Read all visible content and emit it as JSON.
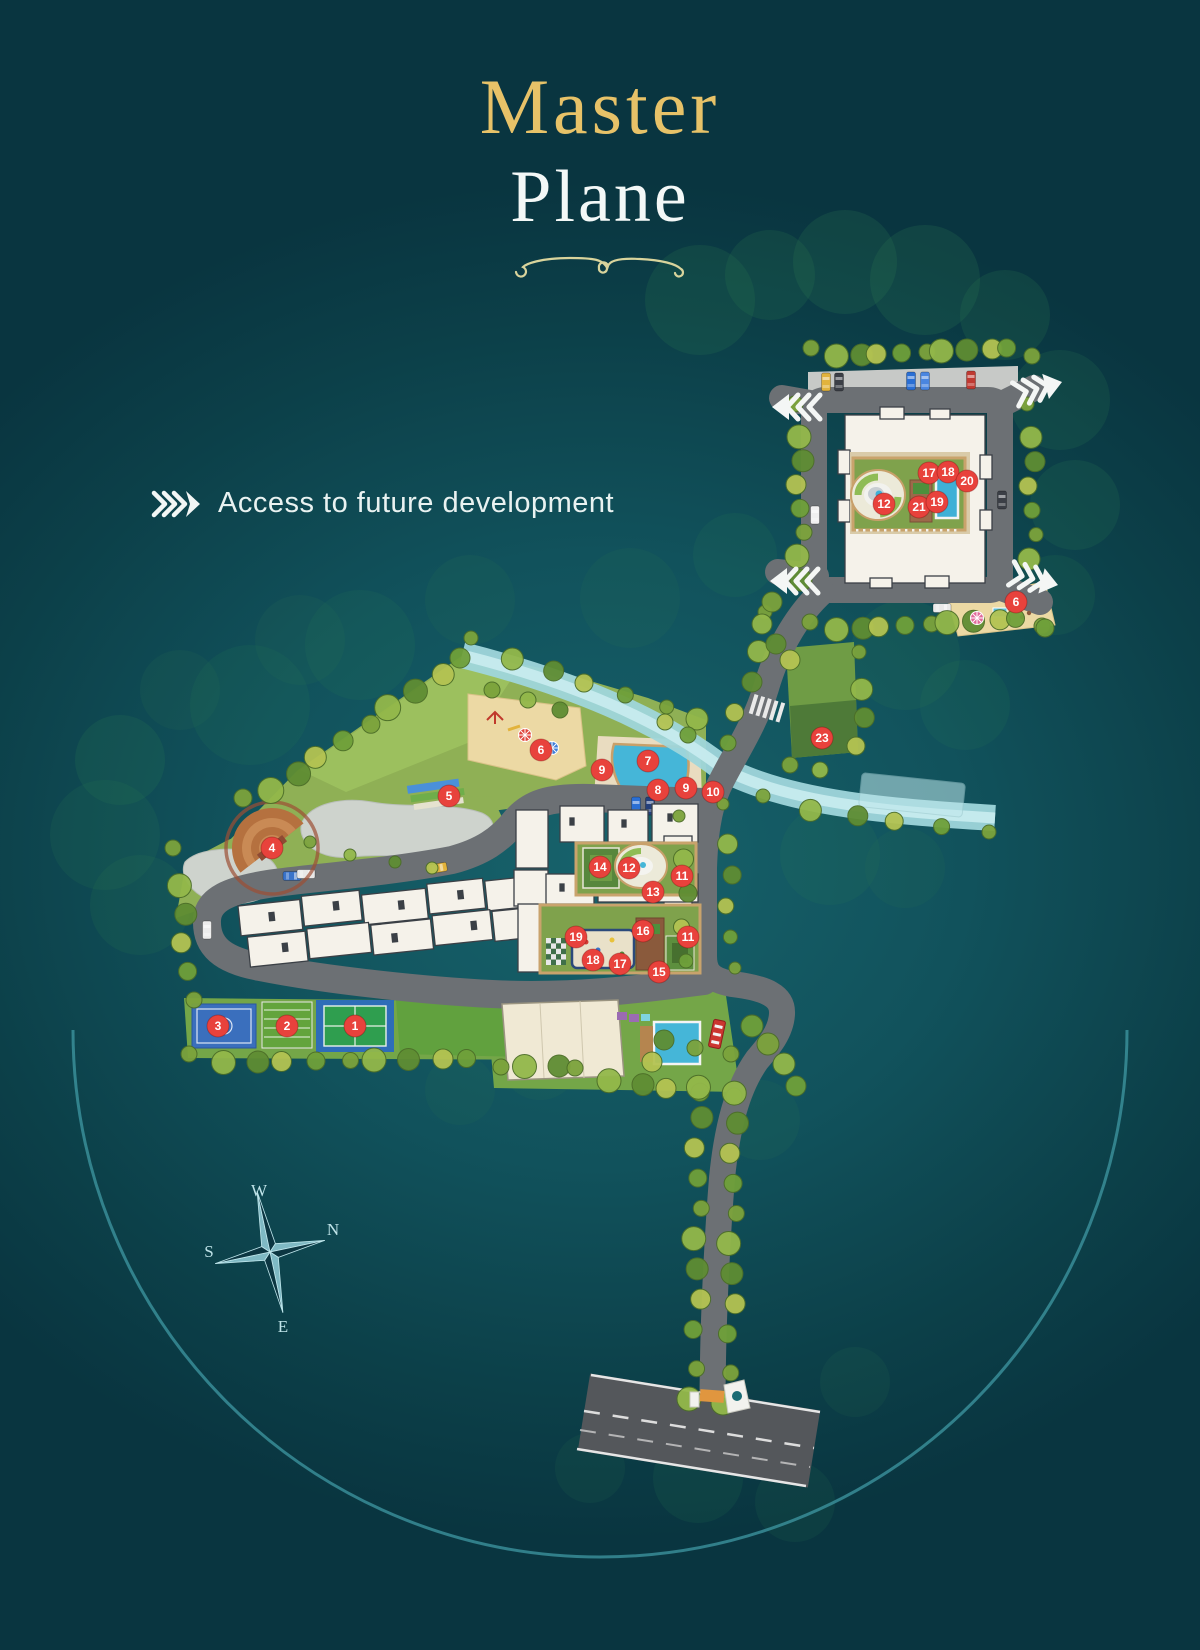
{
  "title": {
    "line1": "Master",
    "line2": "Plane"
  },
  "legend": {
    "label": "Access to future development"
  },
  "compass": {
    "w": "W",
    "n": "N",
    "s": "S",
    "e": "E"
  },
  "map": {
    "marker_color": "#e8423c",
    "markers": [
      {
        "n": "17",
        "x": 929,
        "y": 473
      },
      {
        "n": "18",
        "x": 948,
        "y": 472
      },
      {
        "n": "20",
        "x": 967,
        "y": 481
      },
      {
        "n": "12",
        "x": 884,
        "y": 504
      },
      {
        "n": "21",
        "x": 919,
        "y": 507
      },
      {
        "n": "19",
        "x": 937,
        "y": 502
      },
      {
        "n": "6",
        "x": 1016,
        "y": 602
      },
      {
        "n": "23",
        "x": 822,
        "y": 738
      },
      {
        "n": "6",
        "x": 541,
        "y": 750
      },
      {
        "n": "7",
        "x": 648,
        "y": 761
      },
      {
        "n": "9",
        "x": 602,
        "y": 770
      },
      {
        "n": "8",
        "x": 658,
        "y": 790
      },
      {
        "n": "9",
        "x": 686,
        "y": 788
      },
      {
        "n": "10",
        "x": 713,
        "y": 792
      },
      {
        "n": "5",
        "x": 449,
        "y": 796
      },
      {
        "n": "4",
        "x": 272,
        "y": 848
      },
      {
        "n": "14",
        "x": 600,
        "y": 867
      },
      {
        "n": "12",
        "x": 629,
        "y": 868
      },
      {
        "n": "11",
        "x": 682,
        "y": 876
      },
      {
        "n": "13",
        "x": 653,
        "y": 892
      },
      {
        "n": "19",
        "x": 576,
        "y": 937
      },
      {
        "n": "16",
        "x": 643,
        "y": 931
      },
      {
        "n": "11",
        "x": 688,
        "y": 937
      },
      {
        "n": "18",
        "x": 593,
        "y": 960
      },
      {
        "n": "17",
        "x": 620,
        "y": 964
      },
      {
        "n": "15",
        "x": 659,
        "y": 972
      },
      {
        "n": "3",
        "x": 218,
        "y": 1026
      },
      {
        "n": "2",
        "x": 287,
        "y": 1026
      },
      {
        "n": "1",
        "x": 355,
        "y": 1026
      }
    ]
  }
}
